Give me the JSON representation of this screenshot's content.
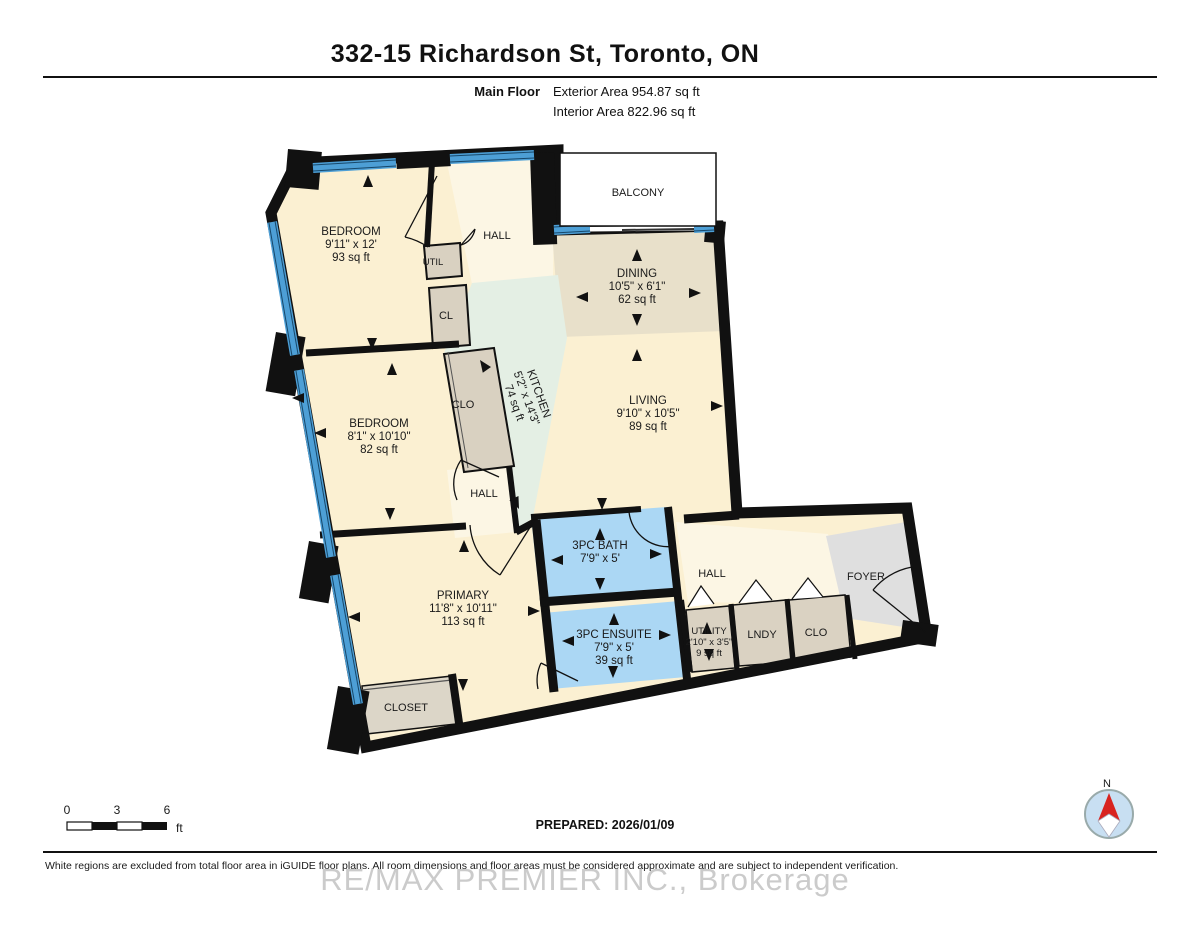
{
  "header": {
    "title": "332-15 Richardson St, Toronto, ON",
    "floor_label": "Main Floor",
    "exterior_area": "Exterior Area 954.87 sq ft",
    "interior_area": "Interior Area 822.96 sq ft"
  },
  "rooms": {
    "bedroom1": {
      "name": "BEDROOM",
      "dims": "9'11\" x 12'",
      "area": "93 sq ft"
    },
    "bedroom2": {
      "name": "BEDROOM",
      "dims": "8'1\" x 10'10\"",
      "area": "82 sq ft"
    },
    "primary": {
      "name": "PRIMARY",
      "dims": "11'8\" x 10'11\"",
      "area": "113 sq ft"
    },
    "living": {
      "name": "LIVING",
      "dims": "9'10\" x 10'5\"",
      "area": "89 sq ft"
    },
    "dining": {
      "name": "DINING",
      "dims": "10'5\" x 6'1\"",
      "area": "62 sq ft"
    },
    "kitchen": {
      "name": "KITCHEN",
      "dims": "5'2\" x 14'3\"",
      "area": "74 sq ft"
    },
    "bath": {
      "name": "3PC BATH",
      "dims": "7'9\" x 5'"
    },
    "ensuite": {
      "name": "3PC ENSUITE",
      "dims": "7'9\" x 5'",
      "area": "39 sq ft"
    },
    "utility": {
      "name": "UTILITY",
      "dims": "2'10\" x 3'5\"",
      "area": "9 sq ft"
    },
    "balcony": {
      "name": "BALCONY"
    },
    "hall_top": {
      "name": "HALL"
    },
    "hall_mid": {
      "name": "HALL"
    },
    "hall_lower": {
      "name": "HALL"
    },
    "foyer": {
      "name": "FOYER"
    },
    "lndy": {
      "name": "LNDY"
    },
    "clo_lower": {
      "name": "CLO"
    },
    "clo_kitchen": {
      "name": "CLO"
    },
    "cl": {
      "name": "CL"
    },
    "util": {
      "name": "UTIL"
    },
    "closet_primary": {
      "name": "CLOSET"
    }
  },
  "scale_bar": {
    "tick0": "0",
    "tick3": "3",
    "tick6": "6",
    "unit": "ft"
  },
  "compass": {
    "north_label": "N"
  },
  "footer": {
    "prepared": "PREPARED: 2026/01/09",
    "disclaimer": "White regions are excluded from total floor area in iGUIDE floor plans. All room dimensions and floor areas must be considered approximate and are subject to independent verification.",
    "watermark": "RE/MAX PREMIER INC., Brokerage"
  },
  "colors": {
    "room_cream": "#FBF0D2",
    "hall_cream": "#FCF6E4",
    "dining_tan": "#E8E0CA",
    "kitchen_mint": "#E4EFE4",
    "bath_blue": "#ABD7F4",
    "storage_tan": "#DAD2C2",
    "foyer_gray": "#DFDFDF",
    "window_blue": "#4D9FD6",
    "wall_black": "#111111"
  }
}
